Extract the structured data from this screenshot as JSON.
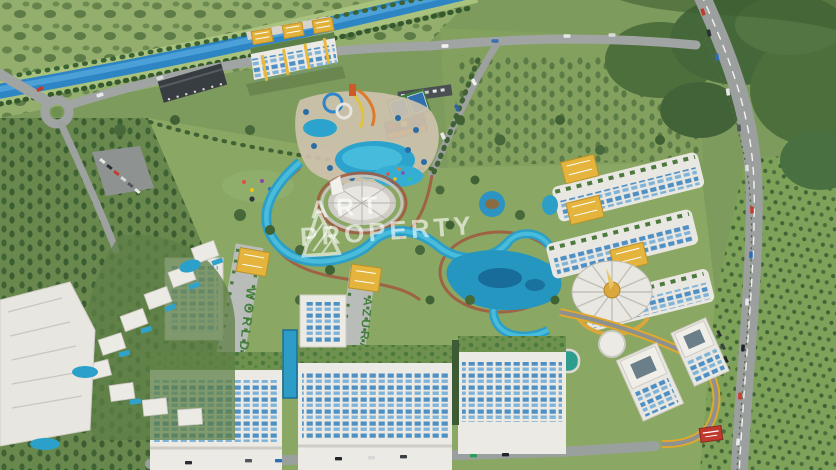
{
  "image": {
    "kind": "3d-aerial-architectural-render",
    "subject": "Resort residential complex masterplan with aquapark, lazy river, villas, apartment blocks, highway and river"
  },
  "watermark": {
    "logo": "triangle-mountain-logo",
    "line1": "ART",
    "line2": "PROPERTY",
    "text_color": "#ffffff"
  },
  "rooftop_letters": {
    "west_wing": "WORLD",
    "east_wing": "AZURA"
  },
  "palette": {
    "grass": "#7d9b5c",
    "field_light": "#94ae6e",
    "forest": "#69884d",
    "river": "#2e85c4",
    "pool": "#2ba3cc",
    "lazy_river": "#2d9fc6",
    "road": "#9fa3a2",
    "building_white": "#eceae5",
    "window_blue": "#4e8fc4",
    "accent_gold": "#e2b13a",
    "path_terracotta": "#a2573f",
    "roof_garden": "#6f9150",
    "sign_red": "#bf3a2e"
  },
  "features": [
    "river with tree-lined banks",
    "roundabout and access roads with cars",
    "curving highway with traffic",
    "orchard rows and forest",
    "main hotel block with gold roof pergolas",
    "aquapark with water slides and splash pools",
    "tennis courts",
    "amphitheater dome",
    "lazy river pools with island",
    "round landmark tent tower",
    "curved apartment terraces",
    "twin towers with yellow ramp and red sign",
    "apartment slabs with roof gardens",
    "hedge letters on wing roofs",
    "villas with private pools",
    "playground",
    "parking lots and street parking"
  ]
}
